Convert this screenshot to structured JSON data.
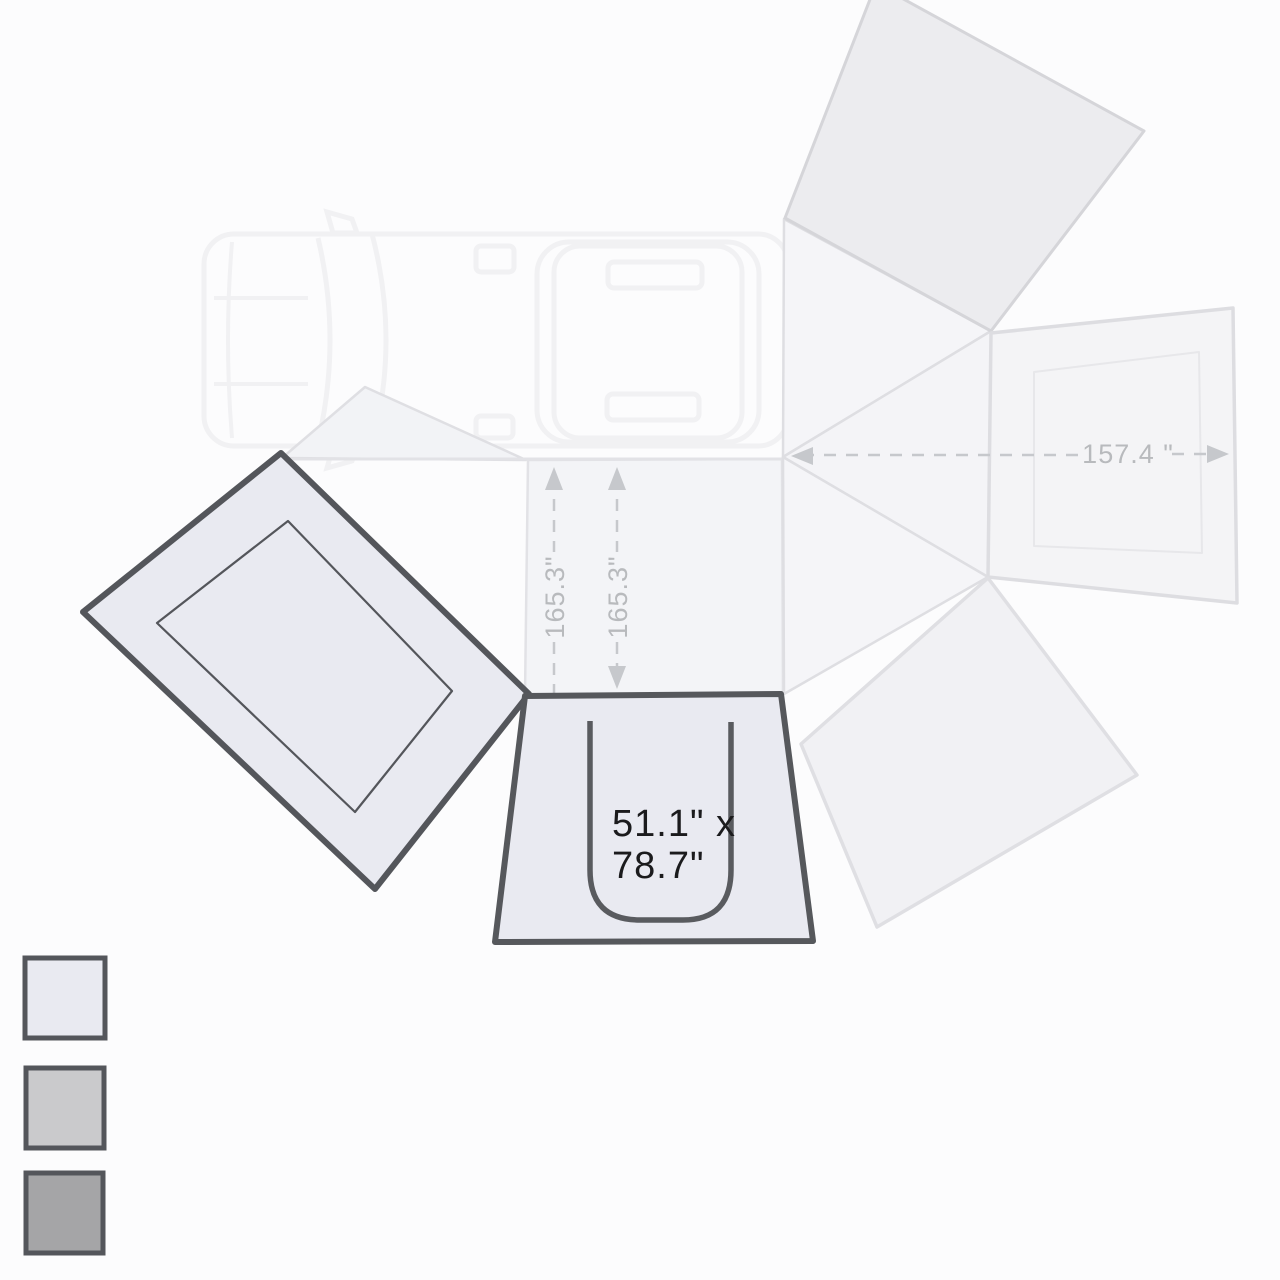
{
  "diagram": {
    "name": "vehicle-270-awning-top-view-dimensions",
    "labels": {
      "left_span": "165.3\"",
      "right_span": "165.3\"",
      "rear_span": "157.4 \"",
      "panel_size_line1": "51.1\" x",
      "panel_size_line2": "78.7\""
    },
    "colors": {
      "background": "#fcfcfd",
      "highlight_fill": "#e9eaf1",
      "highlight_stroke": "#54565b",
      "faint_panel_fill": "#f3f4f7",
      "faint_panel_fill_dark": "#ececef",
      "faint_stroke": "#dfdfe3",
      "car_stroke": "#f1f1f3",
      "dim_arrow_light": "#c6c8cc",
      "dim_arrow_dark": "#77797c",
      "text_dark": "#1b1b1d",
      "text_dim": "#b8babd"
    },
    "legend": {
      "swatches": [
        {
          "name": "swatch-light",
          "fill": "#e9eaf1"
        },
        {
          "name": "swatch-medium",
          "fill": "#cacacc"
        },
        {
          "name": "swatch-dark",
          "fill": "#a5a5a7"
        }
      ]
    }
  }
}
